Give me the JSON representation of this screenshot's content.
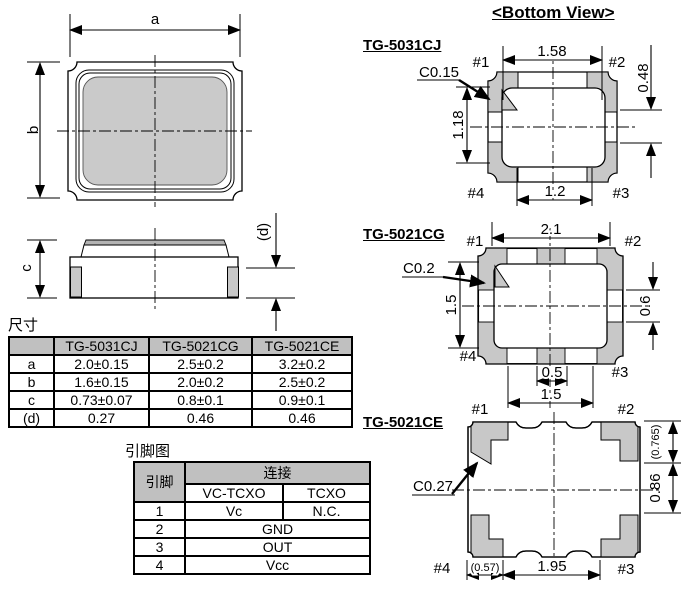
{
  "title": "<Bottom View>",
  "axis_labels": {
    "a": "a",
    "b": "b",
    "c": "c",
    "d": "(d)"
  },
  "pin_labels": {
    "p1": "#1",
    "p2": "#2",
    "p3": "#3",
    "p4": "#4"
  },
  "views": {
    "cj": {
      "name": "TG-5031CJ",
      "chamfer": "C0.15",
      "dims": {
        "top": "1.58",
        "left": "1.18",
        "right": "0.48",
        "bottom": "1.2"
      }
    },
    "cg": {
      "name": "TG-5021CG",
      "chamfer": "C0.2",
      "dims": {
        "top": "2.1",
        "left": "1.5",
        "right": "0.6",
        "bottom_pad": "0.5",
        "bottom": "1.5"
      }
    },
    "ce": {
      "name": "TG-5021CE",
      "chamfer": "C0.27",
      "dims": {
        "right_top": "(0.765)",
        "right_bottom": "0.86",
        "bottom_left": "(0.57)",
        "bottom": "1.95"
      }
    }
  },
  "dim_table": {
    "title": "尺寸",
    "headers": [
      "",
      "TG-5031CJ",
      "TG-5021CG",
      "TG-5021CE"
    ],
    "rows": [
      [
        "a",
        "2.0±0.15",
        "2.5±0.2",
        "3.2±0.2"
      ],
      [
        "b",
        "1.6±0.15",
        "2.0±0.2",
        "2.5±0.2"
      ],
      [
        "c",
        "0.73±0.07",
        "0.8±0.1",
        "0.9±0.1"
      ],
      [
        "(d)",
        "0.27",
        "0.46",
        "0.46"
      ]
    ]
  },
  "pin_table": {
    "title": "引脚图",
    "col_pin": "引脚",
    "col_conn": "连接",
    "sub_headers": [
      "VC-TCXO",
      "TCXO"
    ],
    "rows": [
      {
        "pin": "1",
        "vc": "Vc",
        "tcxo": "N.C."
      },
      {
        "pin": "2",
        "all": "GND"
      },
      {
        "pin": "3",
        "all": "OUT"
      },
      {
        "pin": "4",
        "all": "Vcc"
      }
    ]
  },
  "colors": {
    "pad_gray": "#c8c8c8",
    "header_gray": "#c0c0c0",
    "line": "#000000"
  }
}
